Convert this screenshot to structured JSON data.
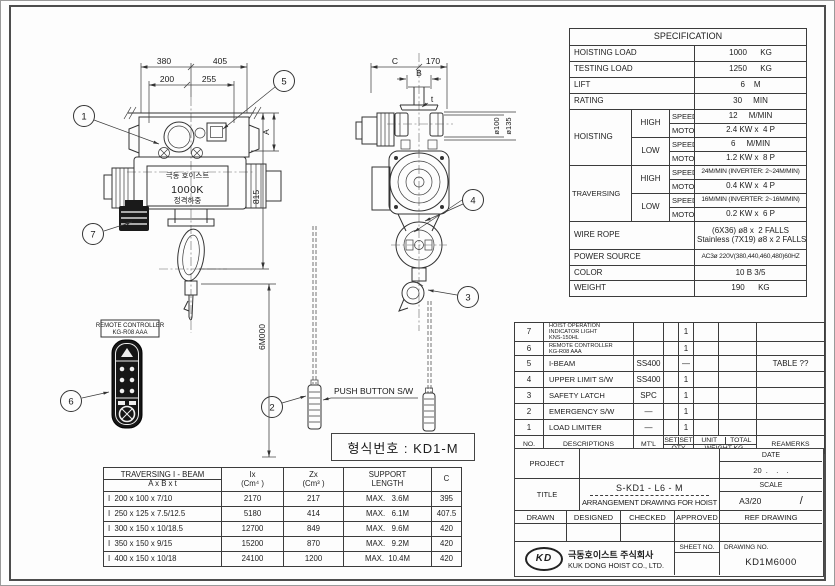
{
  "drawing": {
    "balloons": [
      "1",
      "2",
      "3",
      "4",
      "5",
      "6",
      "7"
    ],
    "dims_front": {
      "w1": "380",
      "w2": "405",
      "w3": "200",
      "w4": "255",
      "a": "A",
      "h": "815",
      "lift": "6M000"
    },
    "dims_side": {
      "c": "C",
      "w": "170",
      "b": "B",
      "t": "t",
      "d1": "ø100",
      "d2": "ø135"
    },
    "nameplate": {
      "line1": "극동 호이스트",
      "line2": "1000K",
      "line3": "정격하중"
    },
    "remote_label": {
      "line1": "REMOTE CONTROLLER",
      "line2": "KG-R08 AAA"
    },
    "push_button_label": "PUSH BUTTON S/W",
    "model_no": "형식번호 : KD1-M"
  },
  "spec": {
    "title": "SPECIFICATION",
    "rows": [
      {
        "label": "HOISTING LOAD",
        "value": "1000      KG"
      },
      {
        "label": "TESTING LOAD",
        "value": "1250      KG"
      },
      {
        "label": "LIFT",
        "value": "6    M"
      },
      {
        "label": "RATING",
        "value": "30     MIN"
      }
    ],
    "hoisting": {
      "label": "HOISTING",
      "high": "HIGH",
      "low": "LOW",
      "speed": "SPEED",
      "motor": "MOTOR",
      "high_speed": "12     M/MIN",
      "high_motor": "2.4 KW x  4 P",
      "low_speed": "6     M/MIN",
      "low_motor": "1.2 KW x  8 P"
    },
    "traversing": {
      "label": "TRAVERSING",
      "high": "HIGH",
      "low": "LOW",
      "speed": "SPEED",
      "motor": "MOTOR",
      "high_speed": "24M/MIN (INVERTER: 2~24M/MIN)",
      "high_motor": "0.4 KW x  4 P",
      "low_speed": "16M/MIN (INVERTER: 2~16M/MIN)",
      "low_motor": "0.2 KW x  6 P"
    },
    "wire_rope": {
      "label": "WIRE ROPE",
      "line1": "(6X36) ø8 x  2 FALLS",
      "line2": "Stainless (7X19) ø8 x 2 FALLS"
    },
    "power": {
      "label": "POWER SOURCE",
      "value": "AC3ø 220V(380,440,460,480)60HZ"
    },
    "color": {
      "label": "COLOR",
      "value": "10 B 3/5"
    },
    "weight": {
      "label": "WEIGHT",
      "value": "190      KG"
    }
  },
  "parts": {
    "headers": {
      "no": "NO.",
      "desc": "DESCRIPTIONS",
      "mtl": "MT'L",
      "set1": "SET",
      "set2": "SET",
      "qty": "QTY",
      "unit": "UNIT",
      "total": "TOTAL",
      "weight": "WEIGHT KG.",
      "remarks": "REAMERKS"
    },
    "rows": [
      {
        "no": "7",
        "desc": "HOIST OPERATION INDICATOR LIGHT",
        "desc2": "KNS-150HL",
        "mtl": "",
        "qty": "1",
        "remarks": ""
      },
      {
        "no": "6",
        "desc": "REMOTE CONTROLLER",
        "desc2": "KG-R08 AAA",
        "mtl": "",
        "qty": "1",
        "remarks": ""
      },
      {
        "no": "5",
        "desc": "I-BEAM",
        "mtl": "SS400",
        "qty": "—",
        "remarks": "TABLE ??"
      },
      {
        "no": "4",
        "desc": "UPPER LIMIT S/W",
        "mtl": "SS400",
        "qty": "1",
        "remarks": ""
      },
      {
        "no": "3",
        "desc": "SAFETY LATCH",
        "mtl": "SPC",
        "qty": "1",
        "remarks": ""
      },
      {
        "no": "2",
        "desc": "EMERGENCY S/W",
        "mtl": "—",
        "qty": "1",
        "remarks": ""
      },
      {
        "no": "1",
        "desc": "LOAD LIMITER",
        "mtl": "—",
        "qty": "1",
        "remarks": ""
      }
    ]
  },
  "tblock": {
    "project_label": "PROJECT",
    "date_label": "DATE",
    "date_value": "20  .    .    .",
    "title_label": "TITLE",
    "title_line1": "S-KD1 - L6 - M",
    "title_line2": "ARRANGEMENT DRAWING FOR HOIST",
    "scale_label": "SCALE",
    "scale_value": "A3/20",
    "scale_extra": "/",
    "drawn": "DRAWN",
    "designed": "DESIGNED",
    "checked": "CHECKED",
    "approved": "APPROVED",
    "ref": "REF DRAWING",
    "logo": "KD",
    "company_kr": "극동호이스트 주식회사",
    "company_en": "KUK DONG HOIST CO., LTD.",
    "sheet_label": "SHEET NO.",
    "drawing_label": "DRAWING NO.",
    "drawing_no": "KD1M6000"
  },
  "ibeam": {
    "header": {
      "title": "TRAVERSING  I - BEAM",
      "sub": "A x B x t",
      "ix1": "Ix",
      "ix2": "(Cm⁴ )",
      "zx1": "Zx",
      "zx2": "(Cm³ )",
      "support1": "SUPPORT",
      "support2": "LENGTH",
      "c": "C"
    },
    "rows": [
      {
        "size": "I  200 x 100 x 7/10",
        "ix": "2170",
        "zx": "217",
        "support": "MAX.   3.6M",
        "c": "395"
      },
      {
        "size": "I  250 x 125 x 7.5/12.5",
        "ix": "5180",
        "zx": "414",
        "support": "MAX.   6.1M",
        "c": "407.5"
      },
      {
        "size": "I  300 x 150 x 10/18.5",
        "ix": "12700",
        "zx": "849",
        "support": "MAX.   9.6M",
        "c": "420"
      },
      {
        "size": "I  350 x 150 x 9/15",
        "ix": "15200",
        "zx": "870",
        "support": "MAX.   9.2M",
        "c": "420"
      },
      {
        "size": "I  400 x 150 x 10/18",
        "ix": "24100",
        "zx": "1200",
        "support": "MAX.  10.4M",
        "c": "420"
      }
    ]
  }
}
